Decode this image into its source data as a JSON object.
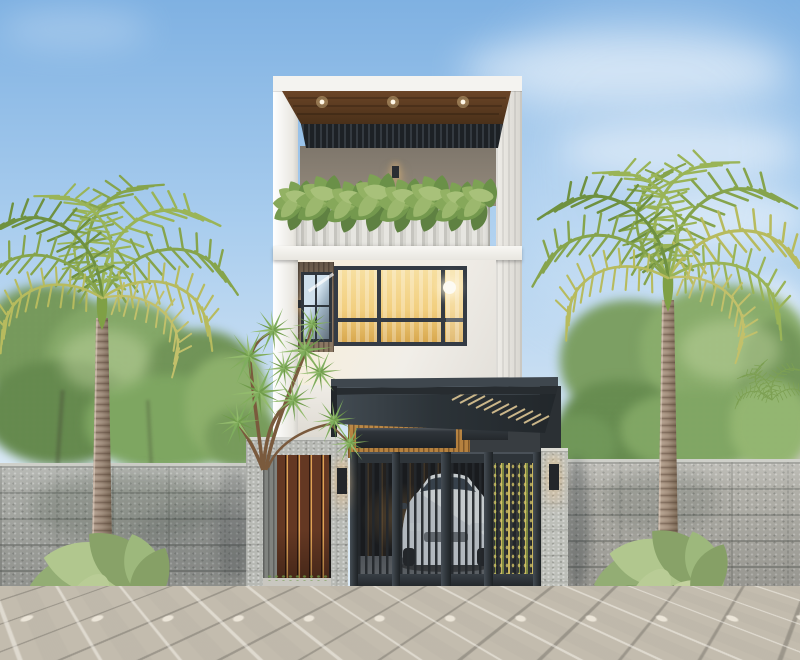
{
  "meta": {
    "canvas_width": 800,
    "canvas_height": 660,
    "scene": "modern-townhouse-street-elevation-render"
  },
  "colors": {
    "sky_top": "#7fb1e2",
    "sky_mid": "#a9cdee",
    "sky_low": "#dcebf7",
    "cloud": "#ffffff",
    "foliage_dark": "#5c8244",
    "foliage_mid": "#76a058",
    "foliage_light": "#93b46b",
    "foliage_pale": "#b9cf97",
    "palm_1": "#6f9140",
    "palm_2": "#86a44c",
    "palm_3": "#9ab457",
    "palm_4": "#b7bb5e",
    "palm_5": "#c2c06a",
    "trunk": "#9b8878",
    "trunk_light": "#c3b2a1",
    "crownshaft": "#7fa045",
    "wall_stone": "#a8aaa5",
    "wall_cap": "#cfd0ca",
    "stone_frame": "#b7b9b4",
    "pillar": "#bdbfb9",
    "fascia": "#f4f3f0",
    "facade": "#f1eee8",
    "facade_warm": "#f6eedd",
    "wood_ceiling": "#5d3e27",
    "slat_dark": "#23282c",
    "taupe_wall": "#8d8376",
    "accent_wood": "#9c5a31",
    "parapet": "#dad9d3",
    "window_frame": "#343b44",
    "window_glow": "#f2cf7f",
    "window_glow_deep": "#d8a84e",
    "glass_sky": "#cfe0ec",
    "glass_dark": "#62707c",
    "carport_canopy": "#272c30",
    "carport_canopy_light": "#434c53",
    "carport_wood": "#b5813f",
    "gate": "#2e3439",
    "gate_dark": "#17191c",
    "door_wood": "#643823",
    "door_glow": "#e0a355",
    "car_body": "#e9ecee",
    "car_glass": "#3a4550",
    "bamboo": "#c9b55e",
    "neighbor_wall": "#e0ddd7",
    "neighbor_slab": "#e8eae9",
    "pave": "#c3bcae",
    "pave_insert": "#efe9dd",
    "pave_shadow": "#4f5c72",
    "curb_cap": "#d9d5cc",
    "curb_dark": "#595d61",
    "curb_mid": "#7e8287",
    "soil": "#33402c",
    "leaf_big": "#93ab73"
  },
  "scene": {
    "sky": {
      "clouds": true
    },
    "vegetation": {
      "palm_trees": 2,
      "street_planters": 2,
      "balcony_planter_row": 1,
      "background_trees": true,
      "accent_tree": 1,
      "bamboo_screen": 1
    },
    "house": {
      "storeys": 3,
      "roof_canopy": {
        "material": "wood-slat-louver",
        "recessed_spotlights": 3
      },
      "balcony": {
        "parapet": "ribbed-concrete",
        "wall_lamp": 1,
        "plant_clumps": 8
      },
      "main_window": {
        "lit": true,
        "pendant_lamp": 1,
        "curtains": true
      },
      "secondary_window": {
        "lit": false
      },
      "carport": {
        "canopy": "steel-louver",
        "interior_cladding": "wood-slat",
        "lit": true
      }
    },
    "street_front": {
      "pedestrian_door": {
        "material": "wood-slat",
        "wall_lamp": 1
      },
      "gate": {
        "bar_panels": 3,
        "perforated_panel": 1,
        "pillar_wall_lamp": 1
      },
      "car": {
        "color": "white",
        "parked": true
      },
      "perimeter_wall": "stone-block",
      "pavement": "diamond-pavers",
      "expansion_joint": 1
    },
    "neighborhood": {
      "house_right": 1
    }
  }
}
